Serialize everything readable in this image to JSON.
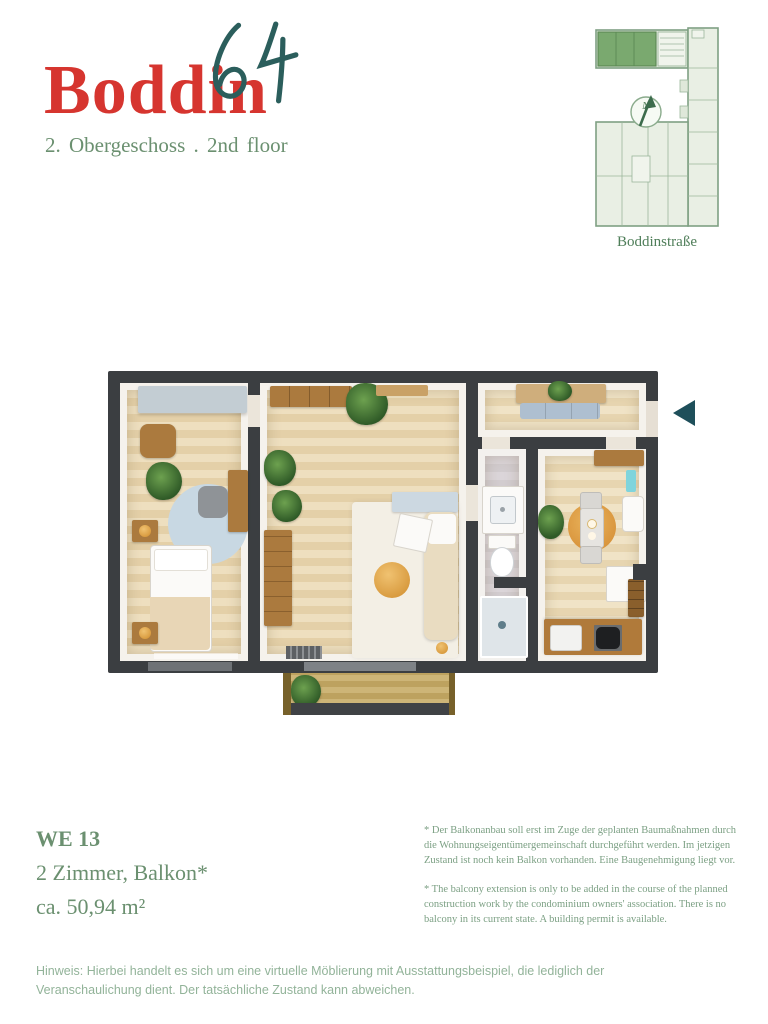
{
  "header": {
    "logo_text": "Boddin",
    "logo_number": "64",
    "floor_label": "2. Obergeschoss . 2nd floor"
  },
  "site_plan": {
    "street_label": "Boddinstraße",
    "compass_label": "N"
  },
  "unit_info": {
    "unit_id": "WE 13",
    "rooms_label": "2 Zimmer, Balkon*",
    "area_label": "ca. 50,94 m²"
  },
  "disclaimers": {
    "german": "* Der Balkonanbau soll erst im Zuge der geplanten Baumaßnahmen durch die Wohnungseigentümergemeinschaft durchgeführt werden. Im jetzigen Zustand ist noch kein Balkon vorhanden. Eine Baugenehmigung liegt vor.",
    "english": "* The balcony extension is only to be added in the course of the planned construction work by the condominium owners' association. There is no balcony in its current state. A building permit is available."
  },
  "footer": {
    "note": "Hinweis: Hierbei handelt es sich um eine virtuelle Möblierung mit Ausstattungsbeispiel, die lediglich der Veranschaulichung dient. Der tatsächliche Zustand kann abweichen."
  },
  "colors": {
    "brand_red": "#d6352f",
    "brand_teal": "#2b5e5c",
    "text_green": "#6b9070",
    "disclaimer_green": "#7ca084",
    "note_green": "#92b399",
    "wall_dark": "#3b3e41",
    "site_highlight_green": "#7aa96f",
    "site_outline_green": "#7fa083",
    "arrow_teal": "#1e4f5a"
  }
}
